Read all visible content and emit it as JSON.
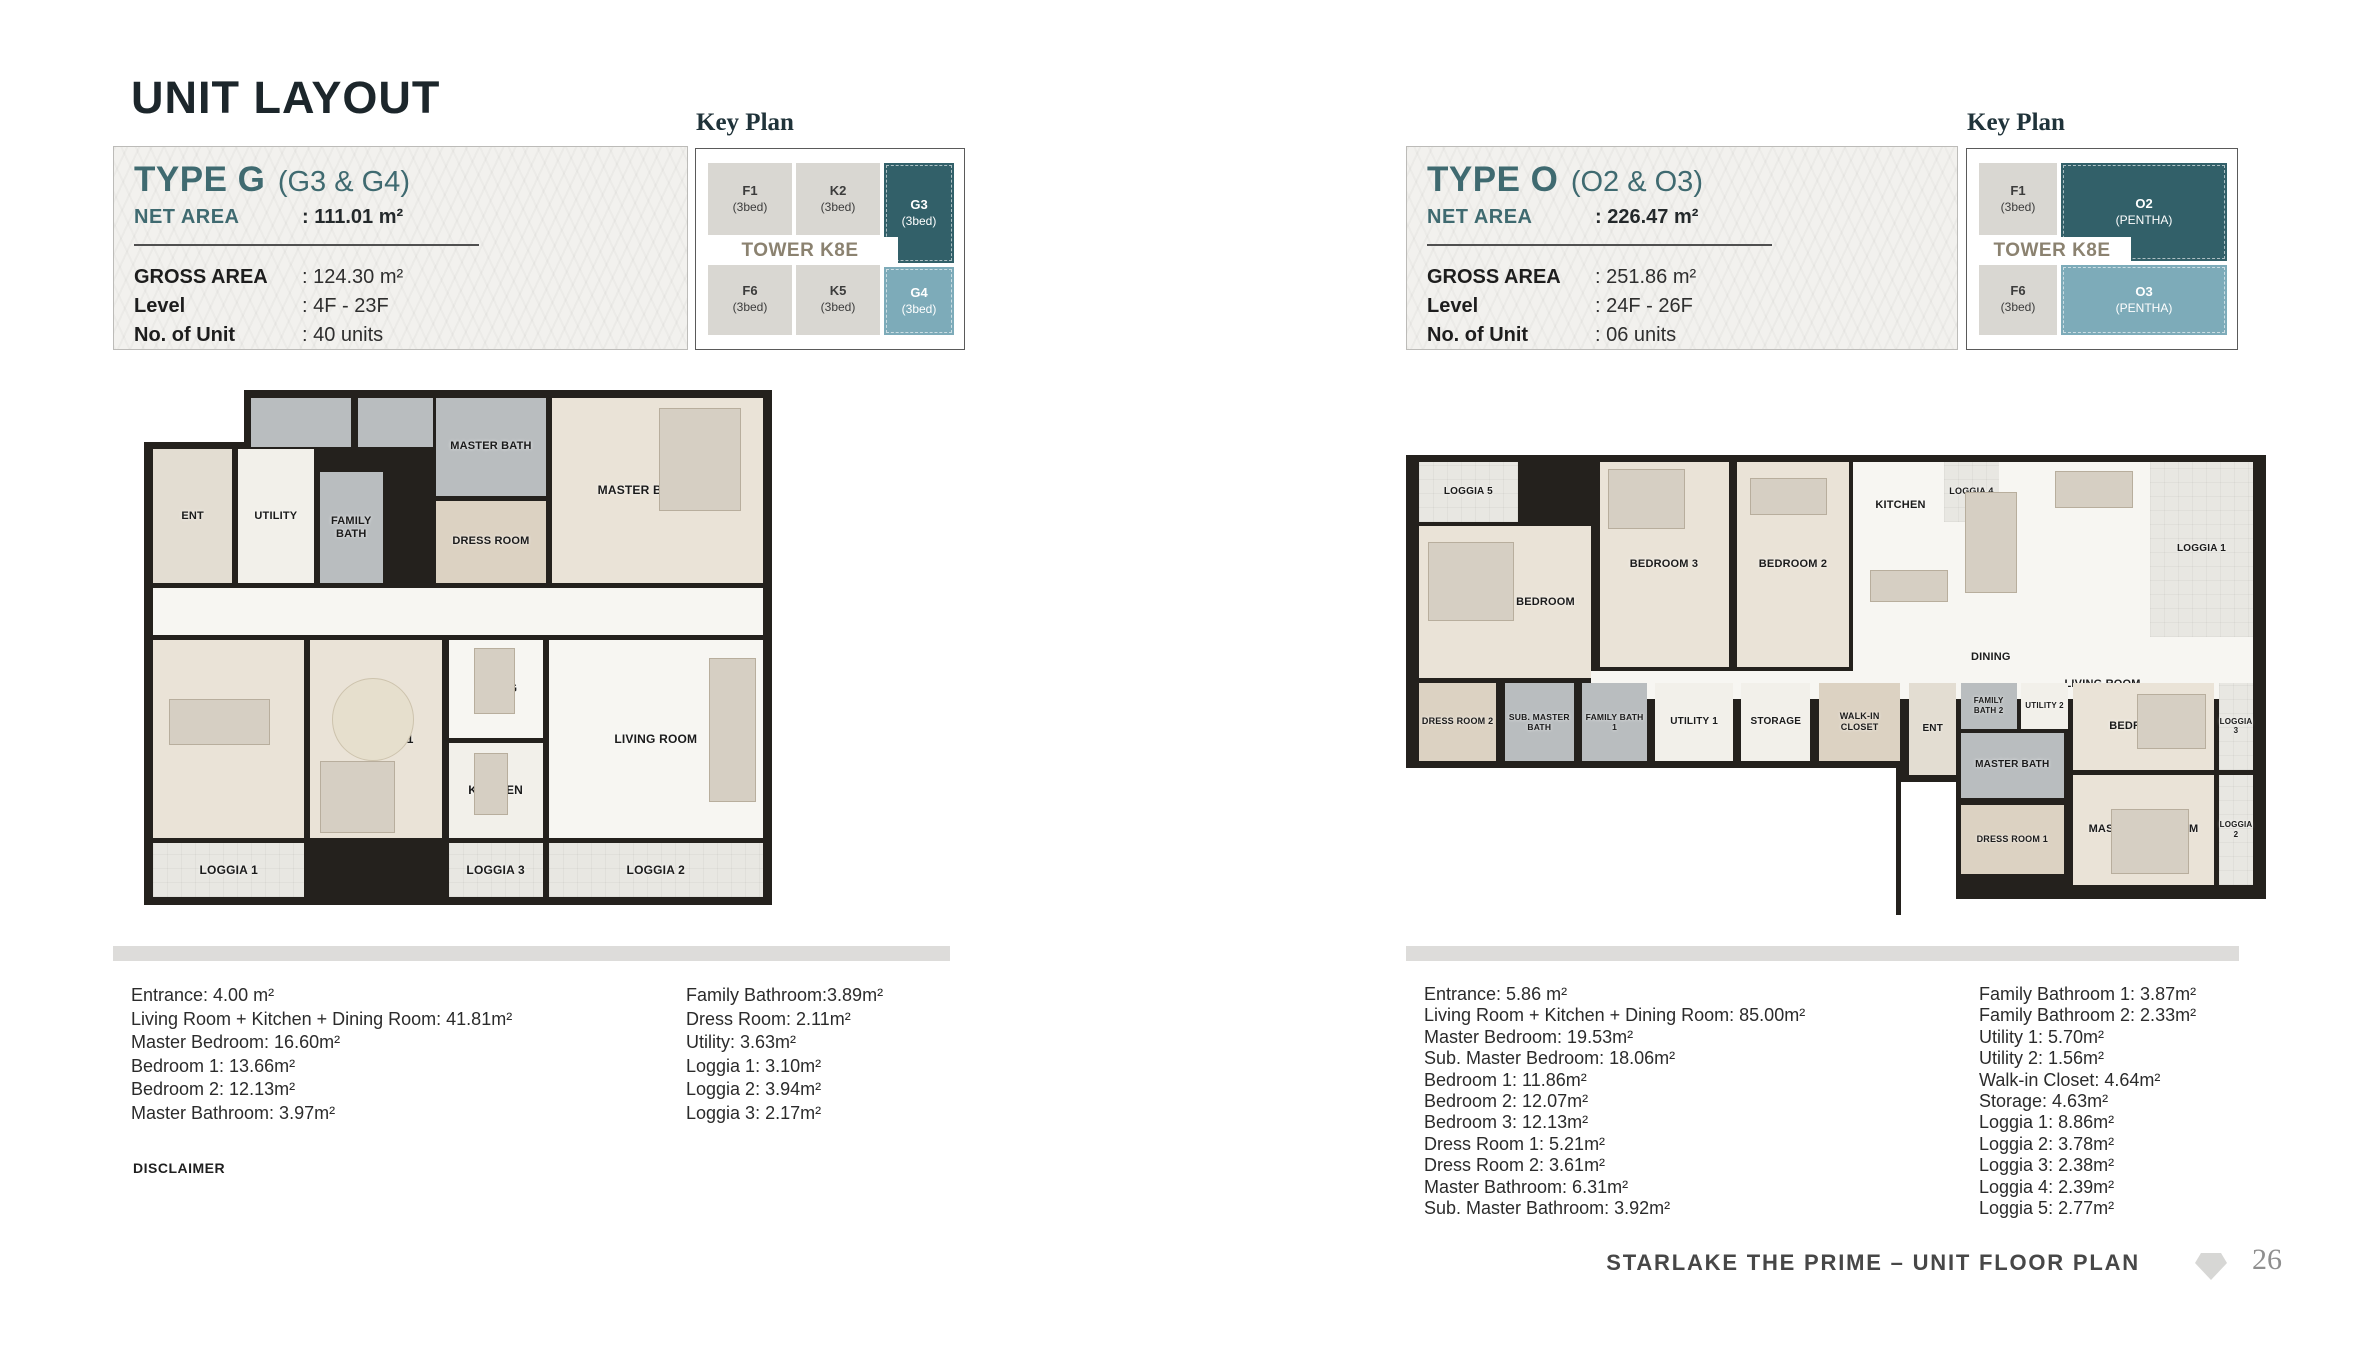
{
  "page": {
    "title": "UNIT LAYOUT",
    "footer": {
      "text": "STARLAKE THE PRIME – UNIT FLOOR PLAN",
      "page_number": "26"
    }
  },
  "colors": {
    "title": "#1c262b",
    "accent": "#3f6a70",
    "kp-dark": "#326069",
    "kp-light": "#7dabb9",
    "wall": "#24211d",
    "tower": "#8b8270",
    "bar": "#dddcda"
  },
  "disclaimer": {
    "heading": "DISCLAIMER",
    "lines": [
      "This floor plan is illustrative and subject to adjustments based on authorities' approval.",
      "The detailed room dimensions provided are for reference only and may vary upon final delivery.",
      "All official information and technical specifications will be stated in the Sale and Purchase Agreement."
    ]
  },
  "units": [
    {
      "id": "type-g",
      "title": "TYPE G",
      "subtitle": "(G3 & G4)",
      "net_area_label": "NET AREA",
      "net_area_value": ": 111.01 m²",
      "specs": [
        {
          "label": "GROSS AREA",
          "value": ": 124.30 m²"
        },
        {
          "label": "Level",
          "value": ": 4F - 23F"
        },
        {
          "label": "No. of Unit",
          "value": ": 40 units"
        }
      ],
      "key_plan": {
        "heading": "Key Plan",
        "tower": "TOWER K8E",
        "tower_band": {
          "x": 6,
          "y": 88,
          "w": 196,
          "h": 28
        },
        "cells": [
          {
            "label": "F1",
            "sub": "(3bed)",
            "style": "gray",
            "x": 12,
            "y": 14,
            "w": 84,
            "h": 72
          },
          {
            "label": "K2",
            "sub": "(3bed)",
            "style": "gray",
            "x": 100,
            "y": 14,
            "w": 84,
            "h": 72
          },
          {
            "label": "G3",
            "sub": "(3bed)",
            "style": "dark",
            "x": 188,
            "y": 14,
            "w": 70,
            "h": 100
          },
          {
            "label": "F6",
            "sub": "(3bed)",
            "style": "gray",
            "x": 12,
            "y": 114,
            "w": 84,
            "h": 72
          },
          {
            "label": "K5",
            "sub": "(3bed)",
            "style": "gray",
            "x": 100,
            "y": 114,
            "w": 84,
            "h": 72
          },
          {
            "label": "G4",
            "sub": "(3bed)",
            "style": "light",
            "x": 188,
            "y": 118,
            "w": 70,
            "h": 68
          }
        ]
      },
      "dimensions_col1": [
        "Entrance: 4.00 m²",
        "Living Room + Kitchen + Dining Room: 41.81m²",
        "Master Bedroom: 16.60m²",
        "Bedroom 1: 13.66m²",
        "Bedroom 2: 12.13m²",
        "Master Bathroom: 3.97m²"
      ],
      "dimensions_col2": [
        "Family Bathroom:3.89m²",
        "Dress Room: 2.11m²",
        "Utility: 3.63m²",
        "Loggia 1: 3.10m²",
        "Loggia 2: 3.94m²",
        "Loggia 3: 2.17m²"
      ],
      "plan": {
        "geometry": {
          "x": 31,
          "y": 244,
          "w": 628,
          "h": 515
        },
        "rooms": [
          {
            "type": "cut",
            "x": 0,
            "y": 0,
            "w": 16,
            "h": 10
          },
          {
            "type": "bath",
            "x": 17,
            "y": 1.5,
            "w": 16,
            "h": 9.5
          },
          {
            "type": "bath",
            "x": 34,
            "y": 1.5,
            "w": 12,
            "h": 9.5
          },
          {
            "label": "MASTER BATH",
            "type": "bath",
            "x": 46.5,
            "y": 1.5,
            "w": 17.5,
            "h": 19,
            "fs": 11
          },
          {
            "label": "MASTER BEDROOM",
            "type": "wood",
            "x": 65,
            "y": 1.5,
            "w": 33.5,
            "h": 36,
            "fs": 12
          },
          {
            "label": "ENT",
            "type": "muted",
            "x": 1.5,
            "y": 11.5,
            "w": 12.5,
            "h": 26,
            "fs": 11
          },
          {
            "label": "UTILITY",
            "type": "tile",
            "x": 15,
            "y": 11.5,
            "w": 12,
            "h": 26,
            "fs": 11
          },
          {
            "label": "FAMILY BATH",
            "type": "bath",
            "x": 28,
            "y": 16,
            "w": 10,
            "h": 21.5,
            "fs": 11
          },
          {
            "label": "DRESS ROOM",
            "type": "closet",
            "x": 46.5,
            "y": 21.5,
            "w": 17.5,
            "h": 16,
            "fs": 11
          },
          {
            "type": "white",
            "x": 1.5,
            "y": 38.5,
            "w": 97,
            "h": 9
          },
          {
            "label": "BEDROOM 2",
            "type": "wood",
            "x": 1.5,
            "y": 48.5,
            "w": 24,
            "h": 38.5
          },
          {
            "label": "BEDROOM 1",
            "type": "wood",
            "x": 26.5,
            "y": 48.5,
            "w": 21,
            "h": 38.5
          },
          {
            "label": "DINING",
            "type": "white",
            "x": 48.5,
            "y": 48.5,
            "w": 15,
            "h": 19
          },
          {
            "label": "KITCHEN",
            "type": "tile",
            "x": 48.5,
            "y": 68.5,
            "w": 15,
            "h": 18.5
          },
          {
            "label": "LIVING ROOM",
            "type": "white",
            "x": 64.5,
            "y": 48.5,
            "w": 34,
            "h": 38.5
          },
          {
            "label": "LOGGIA 1",
            "type": "loggia",
            "x": 1.5,
            "y": 88,
            "w": 24,
            "h": 10.5
          },
          {
            "label": "LOGGIA 3",
            "type": "loggia",
            "x": 48.5,
            "y": 88,
            "w": 15,
            "h": 10.5
          },
          {
            "label": "LOGGIA 2",
            "type": "loggia",
            "x": 64.5,
            "y": 88,
            "w": 34,
            "h": 10.5
          },
          {
            "type": "furn",
            "x": 82,
            "y": 3.5,
            "w": 13,
            "h": 20
          },
          {
            "type": "furn-round",
            "x": 30,
            "y": 56,
            "w": 13,
            "h": 16
          },
          {
            "type": "furn",
            "x": 4,
            "y": 60,
            "w": 16,
            "h": 9
          },
          {
            "type": "furn",
            "x": 90,
            "y": 52,
            "w": 7.5,
            "h": 28
          },
          {
            "type": "furn",
            "x": 52.5,
            "y": 50,
            "w": 6.5,
            "h": 13
          },
          {
            "type": "furn",
            "x": 52.5,
            "y": 70.5,
            "w": 5.5,
            "h": 12
          },
          {
            "type": "furn",
            "x": 28,
            "y": 72,
            "w": 12,
            "h": 14
          }
        ]
      }
    },
    {
      "id": "type-o",
      "title": "TYPE O",
      "subtitle": "(O2 & O3)",
      "net_area_label": "NET AREA",
      "net_area_value": ": 226.47 m²",
      "specs": [
        {
          "label": "GROSS AREA",
          "value": ": 251.86 m²"
        },
        {
          "label": "Level",
          "value": ": 24F - 26F"
        },
        {
          "label": "No. of Unit",
          "value": ": 06 units"
        }
      ],
      "key_plan": {
        "heading": "Key Plan",
        "tower": "TOWER K8E",
        "tower_band": {
          "x": 6,
          "y": 88,
          "w": 158,
          "h": 28
        },
        "cells": [
          {
            "label": "F1",
            "sub": "(3bed)",
            "style": "gray",
            "x": 12,
            "y": 14,
            "w": 78,
            "h": 72
          },
          {
            "label": "O2",
            "sub": "(PENTHA)",
            "style": "dark",
            "x": 94,
            "y": 14,
            "w": 166,
            "h": 98
          },
          {
            "label": "F6",
            "sub": "(3bed)",
            "style": "gray",
            "x": 12,
            "y": 114,
            "w": 78,
            "h": 72
          },
          {
            "label": "O3",
            "sub": "(PENTHA)",
            "style": "light",
            "x": 94,
            "y": 116,
            "w": 166,
            "h": 70
          }
        ]
      },
      "dimensions_col1": [
        "Entrance: 5.86 m²",
        "Living Room + Kitchen + Dining Room: 85.00m²",
        "Master Bedroom: 19.53m²",
        "Sub. Master Bedroom: 18.06m²",
        "Bedroom 1: 11.86m²",
        "Bedroom 2: 12.07m²",
        "Bedroom 3: 12.13m²",
        "Dress Room 1: 5.21m²",
        "Dress Room 2: 3.61m²",
        "Master Bathroom: 6.31m²",
        "Sub. Master Bathroom: 3.92m²"
      ],
      "dimensions_col2": [
        "Family Bathroom 1: 3.87m²",
        "Family Bathroom 2: 2.33m²",
        "Utility 1: 5.70m²",
        "Utility 2: 1.56m²",
        "Walk-in Closet: 4.64m²",
        "Storage: 4.63m²",
        "Loggia 1: 8.86m²",
        "Loggia 2: 3.78m²",
        "Loggia 3: 2.38m²",
        "Loggia 4: 2.39m²",
        "Loggia 5: 2.77m²"
      ],
      "plan": {
        "geometry": {
          "x": 0,
          "y": 309,
          "w": 860,
          "h": 460
        },
        "rooms": [
          {
            "type": "white",
            "x": 52,
            "y": 1.5,
            "w": 46.5,
            "h": 51.5
          },
          {
            "label": "LOGGIA 5",
            "type": "loggia",
            "x": 1.5,
            "y": 1.5,
            "w": 11.5,
            "h": 13,
            "fs": 10
          },
          {
            "label": "SUB. MASTER BEDROOM",
            "type": "wood",
            "x": 1.5,
            "y": 15.5,
            "w": 20,
            "h": 33,
            "fs": 11
          },
          {
            "label": "BEDROOM 3",
            "type": "wood",
            "x": 22.5,
            "y": 1.5,
            "w": 15,
            "h": 44.5,
            "fs": 11
          },
          {
            "label": "BEDROOM 2",
            "type": "wood",
            "x": 38.5,
            "y": 1.5,
            "w": 13,
            "h": 44.5,
            "fs": 11
          },
          {
            "label": "LOGGIA 4",
            "type": "loggia",
            "x": 62.5,
            "y": 1.5,
            "w": 6.5,
            "h": 13,
            "fs": 9
          },
          {
            "label": "LOGGIA 1",
            "type": "loggia",
            "x": 86.5,
            "y": 1.5,
            "w": 12,
            "h": 38,
            "fs": 10
          },
          {
            "label": "KITCHEN",
            "type": "label",
            "x": 52.5,
            "y": 8,
            "w": 10,
            "h": 6,
            "fs": 11
          },
          {
            "label": "DINING",
            "type": "label",
            "x": 63,
            "y": 41,
            "w": 10,
            "h": 6,
            "fs": 11
          },
          {
            "label": "LIVING ROOM",
            "type": "label",
            "x": 74.5,
            "y": 47,
            "w": 13,
            "h": 6,
            "fs": 11
          },
          {
            "type": "white",
            "x": 21.5,
            "y": 47,
            "w": 30.5,
            "h": 6
          },
          {
            "label": "DRESS ROOM 2",
            "type": "closet",
            "x": 1.5,
            "y": 49.5,
            "w": 9,
            "h": 17,
            "fs": 9
          },
          {
            "label": "SUB. MASTER BATH",
            "type": "bath",
            "x": 11.5,
            "y": 49.5,
            "w": 8,
            "h": 17,
            "fs": 8.5
          },
          {
            "label": "FAMILY BATH 1",
            "type": "bath",
            "x": 20.5,
            "y": 49.5,
            "w": 7.5,
            "h": 17,
            "fs": 8.5
          },
          {
            "label": "UTILITY 1",
            "type": "tile",
            "x": 29,
            "y": 49.5,
            "w": 9,
            "h": 17,
            "fs": 10
          },
          {
            "label": "STORAGE",
            "type": "tile",
            "x": 39,
            "y": 49.5,
            "w": 8,
            "h": 17,
            "fs": 10
          },
          {
            "label": "WALK-IN CLOSET",
            "type": "closet",
            "x": 48,
            "y": 49.5,
            "w": 9.5,
            "h": 17,
            "fs": 9
          },
          {
            "label": "ENT",
            "type": "muted",
            "x": 58.5,
            "y": 49.5,
            "w": 5.5,
            "h": 20,
            "fs": 10
          },
          {
            "label": "FAMILY BATH 2",
            "type": "bath",
            "x": 64.5,
            "y": 49.5,
            "w": 6.5,
            "h": 10,
            "fs": 8
          },
          {
            "label": "UTILITY 2",
            "type": "tile",
            "x": 71.5,
            "y": 49.5,
            "w": 5.5,
            "h": 10,
            "fs": 8
          },
          {
            "label": "MASTER BATH",
            "type": "bath",
            "x": 64.5,
            "y": 60.5,
            "w": 12,
            "h": 14,
            "fs": 10
          },
          {
            "label": "BEDROOM 1",
            "type": "wood",
            "x": 77.5,
            "y": 49.5,
            "w": 16.5,
            "h": 19,
            "fs": 11
          },
          {
            "label": "LOGGIA 3",
            "type": "loggia",
            "x": 94.5,
            "y": 49.5,
            "w": 4,
            "h": 19,
            "fs": 8
          },
          {
            "label": "MASTER BEDROOM",
            "type": "wood",
            "x": 77.5,
            "y": 69.5,
            "w": 16.5,
            "h": 24,
            "fs": 11
          },
          {
            "label": "LOGGIA 2",
            "type": "loggia",
            "x": 94.5,
            "y": 69.5,
            "w": 4,
            "h": 24,
            "fs": 8
          },
          {
            "label": "DRESS ROOM 1",
            "type": "closet",
            "x": 64.5,
            "y": 76,
            "w": 12,
            "h": 15,
            "fs": 9
          },
          {
            "type": "cut",
            "x": 0,
            "y": 68,
            "w": 57,
            "h": 32
          },
          {
            "type": "cut",
            "x": 57.5,
            "y": 71,
            "w": 6.5,
            "h": 29
          },
          {
            "type": "cut",
            "x": 60,
            "y": 96.5,
            "w": 40,
            "h": 3.5
          },
          {
            "type": "furn",
            "x": 75.5,
            "y": 3.5,
            "w": 9,
            "h": 8
          },
          {
            "type": "furn",
            "x": 65,
            "y": 8,
            "w": 6,
            "h": 22
          },
          {
            "type": "furn",
            "x": 54,
            "y": 25,
            "w": 9,
            "h": 7
          },
          {
            "type": "furn",
            "x": 23.5,
            "y": 3,
            "w": 9,
            "h": 13
          },
          {
            "type": "furn",
            "x": 40,
            "y": 5,
            "w": 9,
            "h": 8
          },
          {
            "type": "furn",
            "x": 2.5,
            "y": 19,
            "w": 10,
            "h": 17
          },
          {
            "type": "furn",
            "x": 85,
            "y": 52,
            "w": 8,
            "h": 12
          },
          {
            "type": "furn",
            "x": 82,
            "y": 77,
            "w": 9,
            "h": 14
          }
        ]
      }
    }
  ]
}
